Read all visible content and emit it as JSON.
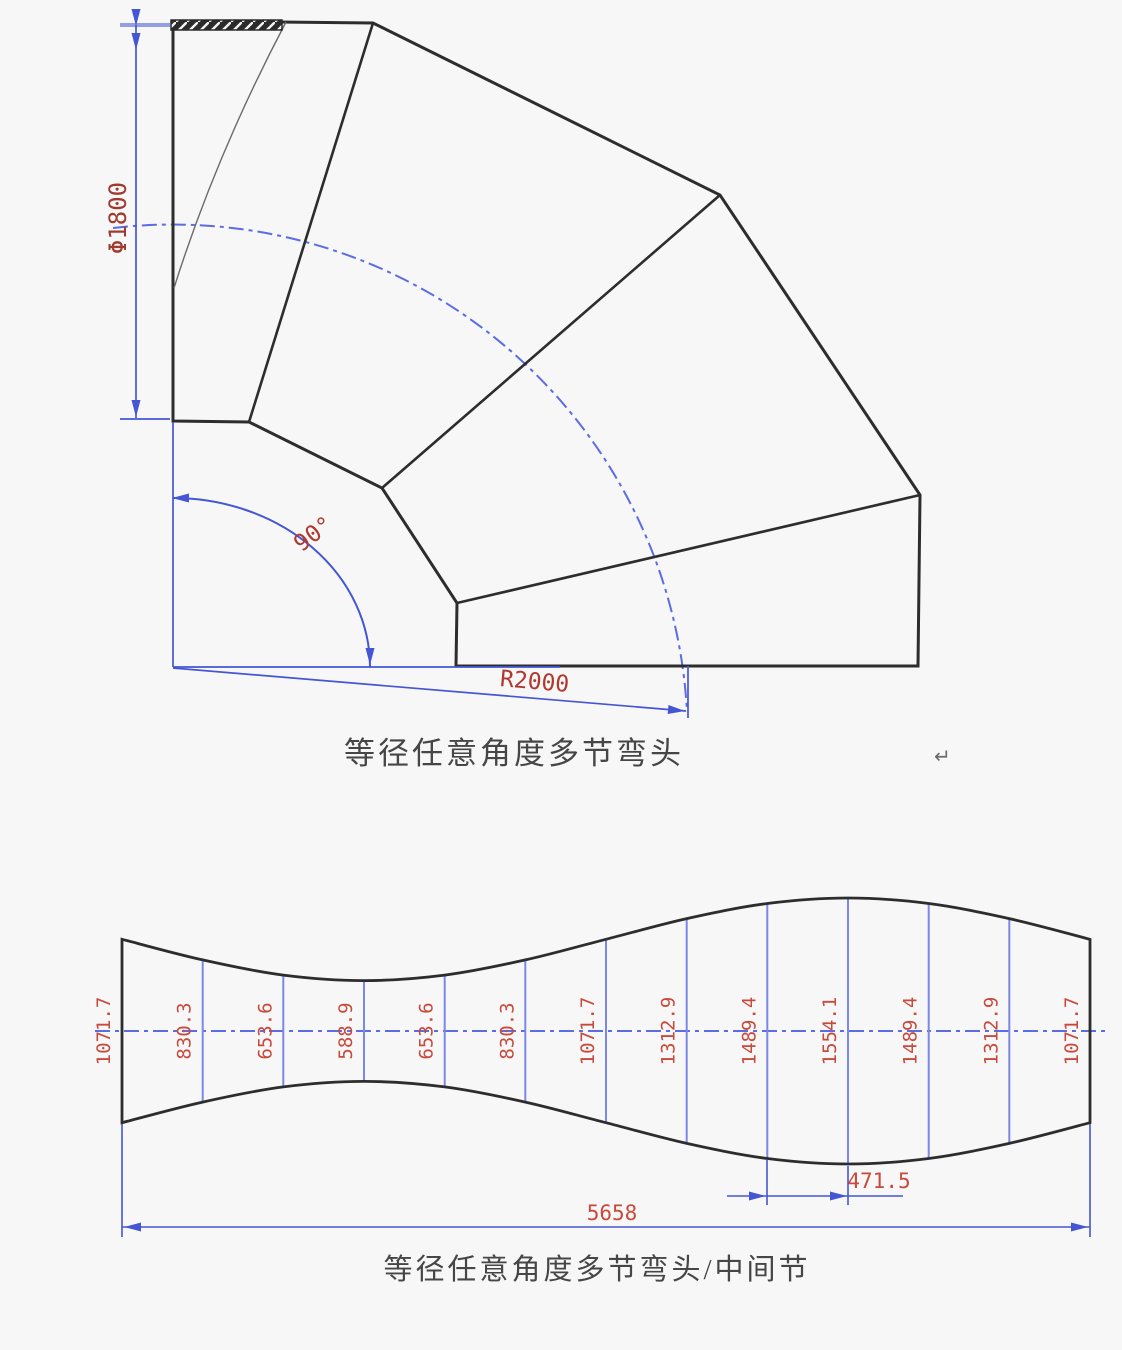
{
  "colors": {
    "bg": "#f7f7f7",
    "line": "#2d2d2d",
    "line_thin": "#6b6b6b",
    "dim_blue": "#4456d4",
    "ord_blue": "#7b88e8",
    "center_blue": "#5b6ce4",
    "red_dark": "#a0392e",
    "red_mid": "#b2372c",
    "red_light": "#c94a3c",
    "caption_gray": "#464646"
  },
  "top_drawing": {
    "caption": "等径任意角度多节弯头",
    "return_mark": "↵",
    "diameter_label": "Φ1800",
    "angle_label": "90°",
    "radius_label": "R2000"
  },
  "bottom_drawing": {
    "caption": "等径任意角度多节弯头/中间节",
    "ordinate_labels": [
      "1071.7",
      "830.3",
      "653.6",
      "588.9",
      "653.6",
      "830.3",
      "1071.7",
      "1312.9",
      "1489.4",
      "1554.1",
      "1489.4",
      "1312.9",
      "1071.7"
    ],
    "pitch_label": "471.5",
    "overall_label": "5658"
  }
}
